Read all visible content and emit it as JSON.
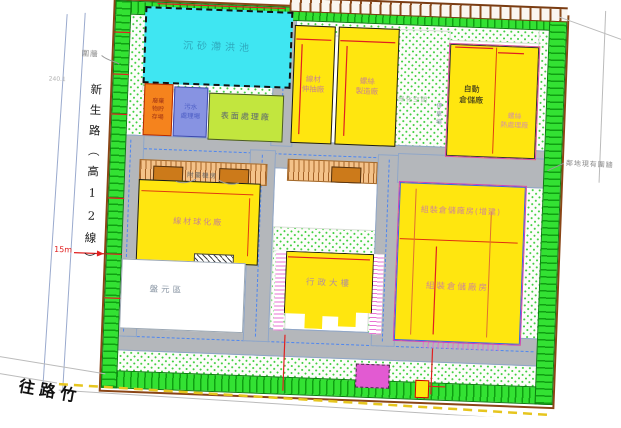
{
  "plan": {
    "road_left": {
      "name": "新生路（高12線）"
    },
    "road_bottom_left": {
      "direction": "往路竹"
    },
    "pond": {
      "label": "沉砂滯洪池"
    },
    "buildings": {
      "waste_storage": {
        "label": "廢棄 物貯 存場"
      },
      "wastewater_plant": {
        "label": "污水 處理場"
      },
      "surface_treatment": {
        "label": "表面處理廠"
      },
      "wire_drawing": {
        "label": "線材 伸抽廠"
      },
      "screw_manufacturing": {
        "label": "螺絲 製造廠"
      },
      "auto_warehouse": {
        "label": "自動 倉儲廠"
      },
      "screw_heat_treatment": {
        "label": "螺絲 熱處理廠"
      },
      "wire_spheroidizing": {
        "label": "線材球化廠"
      },
      "coil_yard": {
        "label": "盤元區"
      },
      "admin_building": {
        "label": "行政大樓"
      },
      "assembly_warehouse_extension": {
        "label": "組裝倉儲廠房(增建)"
      },
      "assembly_warehouse": {
        "label": "組裝倉儲廠房"
      }
    },
    "annotations": {
      "fence": "圍牆",
      "neighbor_fence": "鄰地現有圍牆",
      "aux_room": "附屬機房",
      "green_space": "綠化空間",
      "parking": "停車場",
      "road_width": "15m",
      "survey_mark": "240.1"
    },
    "colors": {
      "building_yellow": "#ffe60f",
      "pond_cyan": "#3fe6f2",
      "landscape_green": "#33e133",
      "road_gray": "#b4b7bb",
      "orange_building": "#f5831d",
      "blue_building": "#8793e2",
      "lightgreen_building": "#c2e63e",
      "magenta_box": "#e25ad2",
      "parking_tan": "#f4c289"
    }
  }
}
